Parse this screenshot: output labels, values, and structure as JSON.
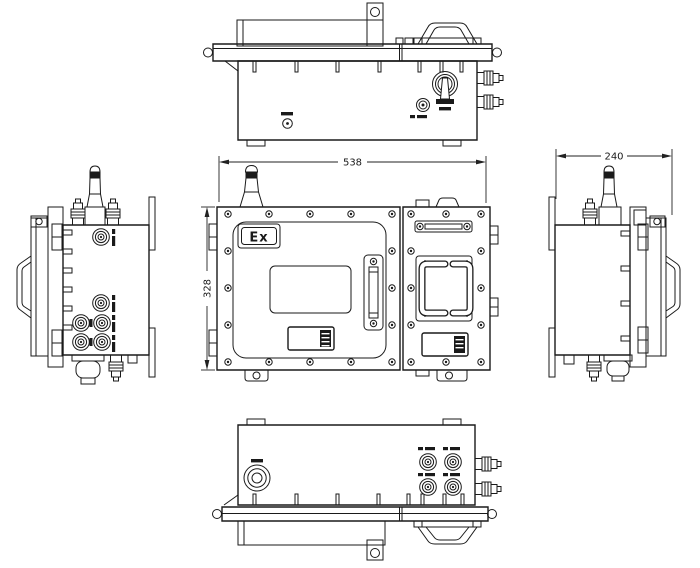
{
  "page": {
    "background": "#ffffff",
    "line_color": "#1a1a1a",
    "dimension_color": "#222222"
  },
  "front_view": {
    "ex_marking": "Ex",
    "width_dimension": "538",
    "height_dimension": "328"
  },
  "right_side_view": {
    "depth_dimension": "240"
  }
}
